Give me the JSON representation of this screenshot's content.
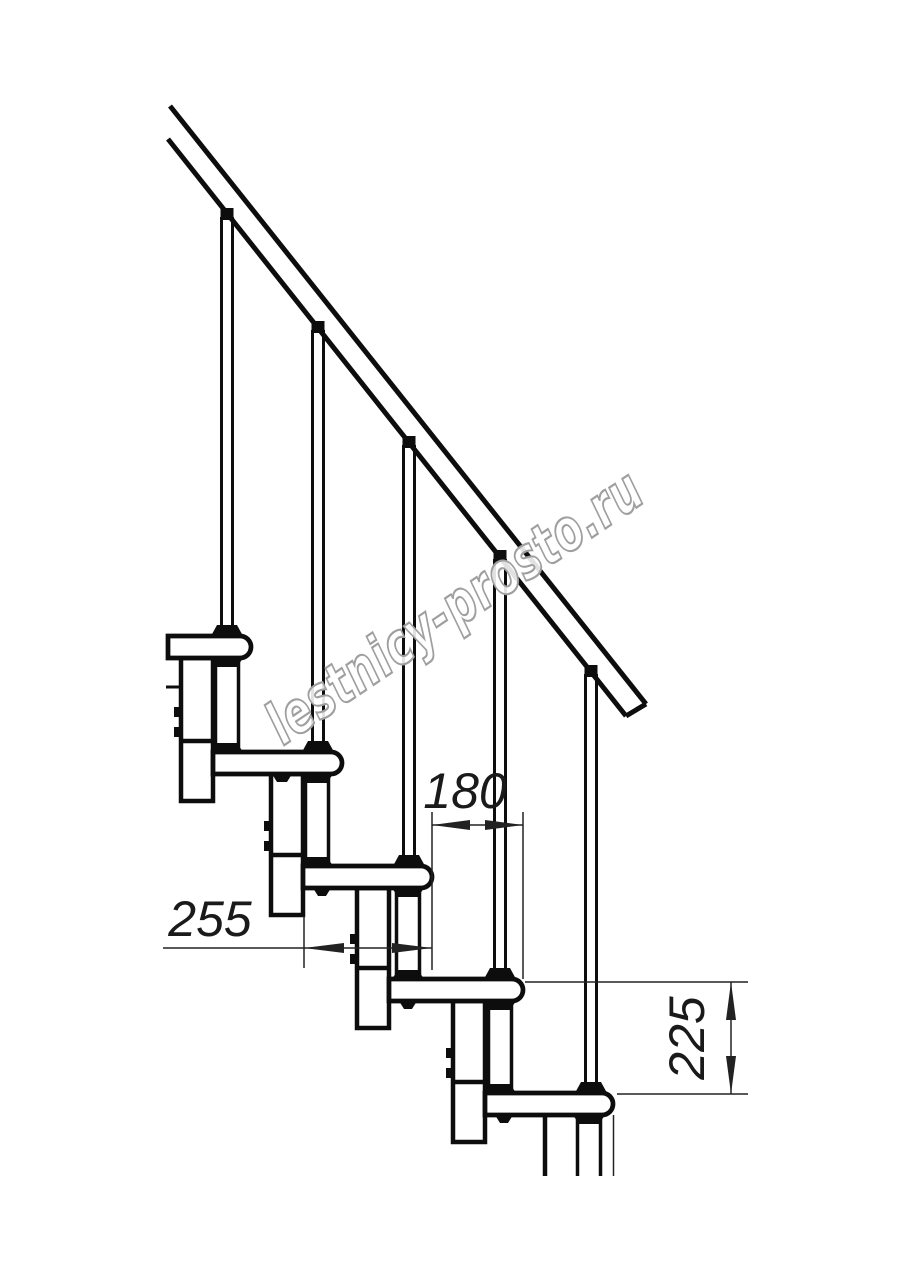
{
  "drawing": {
    "background": "#ffffff",
    "line_color": "#0d0d0d",
    "dim_color": "#222222",
    "dimensions": {
      "tread_depth_label": "255",
      "step_run_label": "180",
      "step_rise_label": "225"
    },
    "watermark": {
      "text": "lestnicy-prosto.ru",
      "outline_color": "#9f9f9f",
      "fill_color": "#ffffff"
    }
  }
}
